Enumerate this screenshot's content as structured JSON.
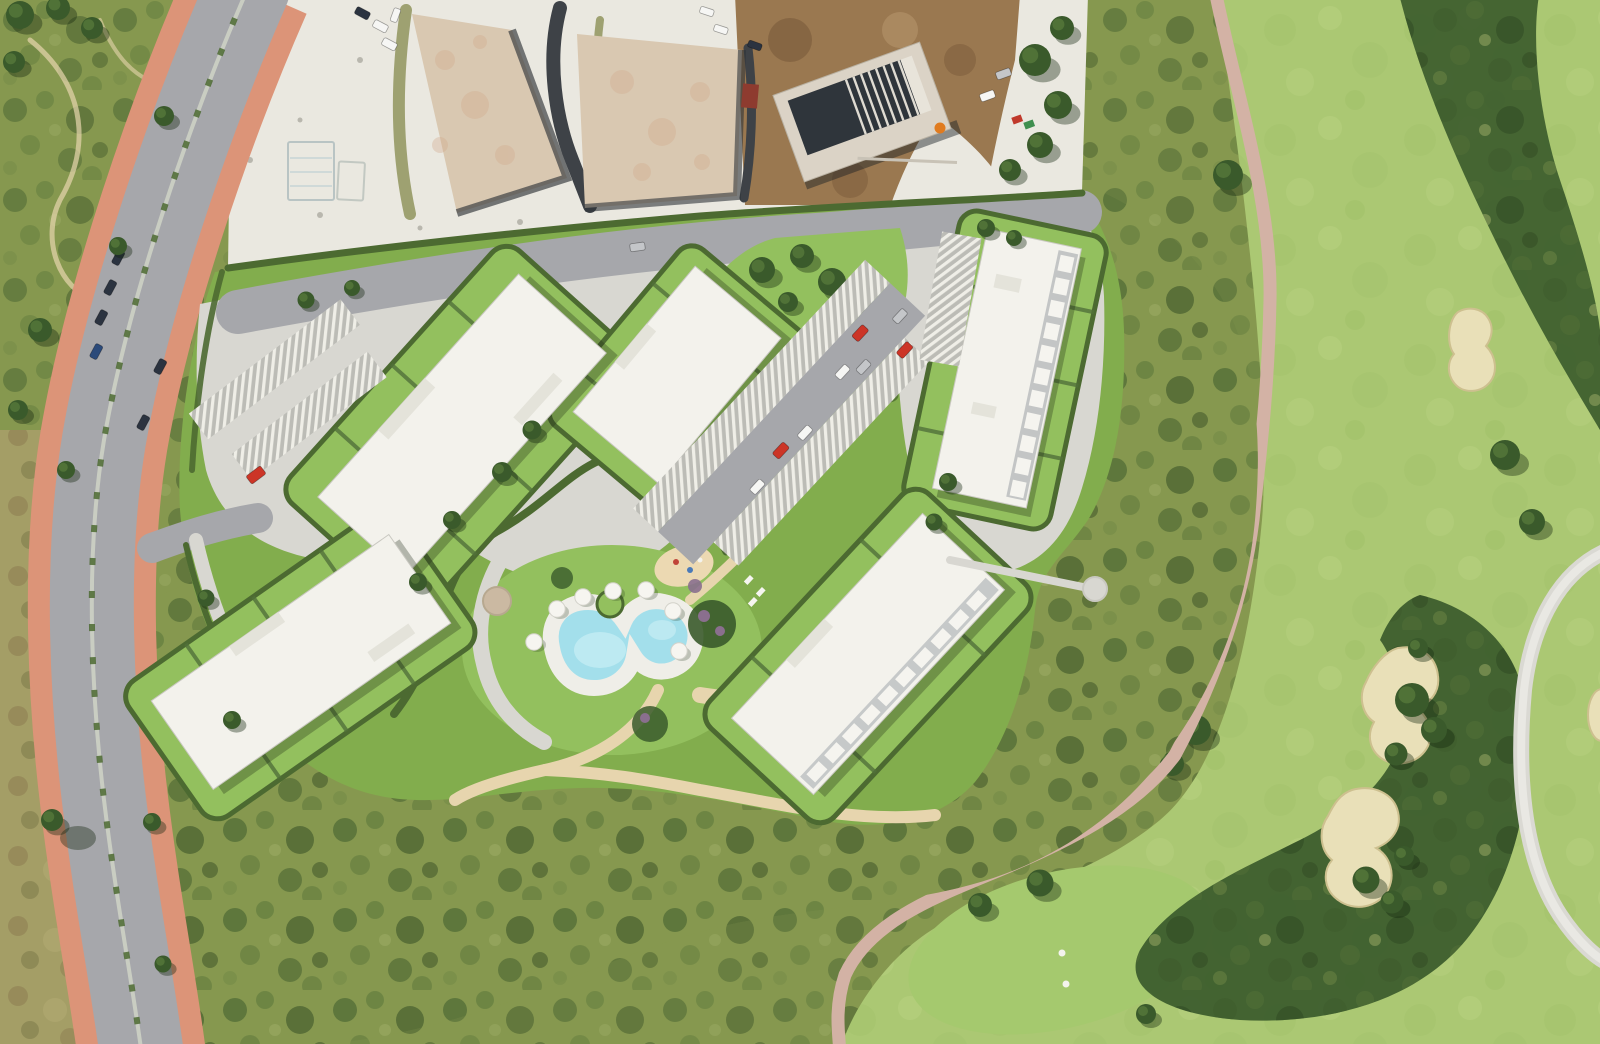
{
  "meta": {
    "view": "aerial-photograph",
    "description": "Top-down aerial view of a coastal resort masterplan: five white apartment blocks with landscaped terraced gardens, carports and a kidney-shaped pool, bordered by an avenue with terracotta sidewalks on the left, construction plots with concrete slab foundations at top, and a golf course with sand bunkers and cart paths on the right."
  },
  "palette": {
    "scrub": "#86984f",
    "scrubDark": "#3e5a2c",
    "scrubDarker": "#2e4722",
    "scrubLight": "#a3b067",
    "dryScrub": "#a49e66",
    "dryBrown": "#8c7b50",
    "fairway": "#abc873",
    "fairwayLight": "#b8d382",
    "teeGreen": "#a5c96e",
    "bunkerSand": "#e9e0b8",
    "bunkerEdge": "#cdc08f",
    "treeDark": "#3a5a2b",
    "treeMid": "#55773a",
    "roadAsphalt": "#a6a7ab",
    "sidewalkPink": "#dc9478",
    "gravelWhite": "#eae8e0",
    "concreteSlab": "#d9c8b1",
    "concretePink": "#d2a98c",
    "dirtBrown": "#9a7850",
    "dirtDark": "#7a5a3a",
    "darkRoof": "#2f353b",
    "devPaving": "#d8d7d1",
    "devLawn": "#82ad4d",
    "devLawnBright": "#93c05e",
    "hedge": "#4c6a31",
    "buildingWhite": "#f3f2ec",
    "poolWater": "#a3dfeb",
    "poolWaterLight": "#c6edf4",
    "poolDeck": "#efeee8",
    "sandPath": "#e7d5ae",
    "pathPink": "#d3b2a5",
    "pathGrey": "#dad9d3",
    "parasolWhite": "#f6f5f0",
    "carportBase": "#bcbcb6",
    "carportSlat": "#efeee7",
    "pavilionTan": "#cbb9a2",
    "playgroundSand": "#ecd9b2",
    "shrubPurple": "#8a6f8e",
    "carRed": "#cc3527",
    "carWhite": "#f6f6f4",
    "carSilver": "#c4c6c9",
    "carDark": "#2b3340",
    "machineOrange": "#e07b1f",
    "containerRed": "#8e3b2f",
    "binGreen": "#3f8f4f"
  },
  "scene": {
    "left_road": {
      "type": "dual carriageway avenue",
      "sidewalks": "terracotta",
      "median": "planted",
      "parked_cars": [
        "dark-blue",
        "dark-blue",
        "dark-blue",
        "white",
        "silver"
      ],
      "street_trees": true
    },
    "construction_zone": {
      "concrete_slab_foundations": 2,
      "building_under_construction": 1,
      "surfaces": [
        "white gravel",
        "brown earth"
      ],
      "equipment": [
        "orange excavator",
        "container",
        "site sheds"
      ]
    },
    "development": {
      "apartment_buildings": 5,
      "roofs": "white",
      "carport_rows": 5,
      "swimming_pool": {
        "shape": "kidney",
        "water": "turquoise",
        "deck": "white",
        "green_island": 1
      },
      "parasols": 7,
      "playground": 1,
      "terraced_hedge_gardens": true,
      "cars": [
        "red",
        "red",
        "white",
        "white",
        "silver",
        "silver"
      ]
    },
    "golf_course": {
      "fairways": 3,
      "sand_bunkers": 4,
      "cart_paths": [
        "pink",
        "grey"
      ],
      "tee_markers": 2,
      "tree_clusters": true
    },
    "vegetation": {
      "mediterranean_scrubland": true,
      "dry_brush_left_verge": true
    }
  }
}
